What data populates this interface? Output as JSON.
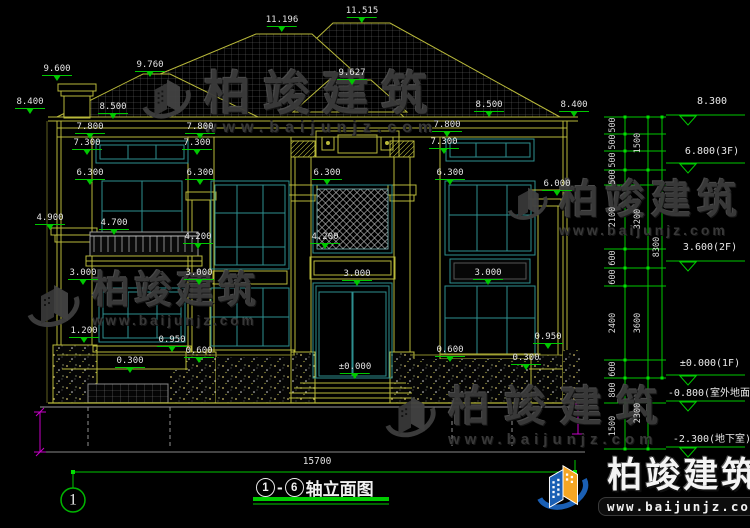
{
  "drawing": {
    "title_axis_start": "1",
    "title_axis_end": "6",
    "title_dash": "-",
    "title_suffix": "轴立面图",
    "overall_width_dim": "15700",
    "axis_bubble": "1"
  },
  "watermark": {
    "brand": "柏竣建筑",
    "url": "www.baijunjz.com"
  },
  "logo": {
    "brand": "柏竣建筑",
    "url": "www.baijunjz.com"
  },
  "dims": [
    {
      "text": "11.196",
      "x": 282,
      "y": 16
    },
    {
      "text": "11.515",
      "x": 362,
      "y": 7
    },
    {
      "text": "9.600",
      "x": 57,
      "y": 65
    },
    {
      "text": "9.760",
      "x": 150,
      "y": 61
    },
    {
      "text": "9.627",
      "x": 352,
      "y": 69
    },
    {
      "text": "8.400",
      "x": 30,
      "y": 98
    },
    {
      "text": "8.500",
      "x": 113,
      "y": 103
    },
    {
      "text": "8.500",
      "x": 489,
      "y": 101
    },
    {
      "text": "8.400",
      "x": 574,
      "y": 101
    },
    {
      "text": "7.800",
      "x": 90,
      "y": 123
    },
    {
      "text": "7.800",
      "x": 200,
      "y": 123
    },
    {
      "text": "7.800",
      "x": 447,
      "y": 121
    },
    {
      "text": "7.300",
      "x": 87,
      "y": 139
    },
    {
      "text": "7.300",
      "x": 197,
      "y": 139
    },
    {
      "text": "7.300",
      "x": 444,
      "y": 138
    },
    {
      "text": "6.300",
      "x": 90,
      "y": 169
    },
    {
      "text": "6.300",
      "x": 200,
      "y": 169
    },
    {
      "text": "6.300",
      "x": 327,
      "y": 169
    },
    {
      "text": "6.300",
      "x": 450,
      "y": 169
    },
    {
      "text": "6.000",
      "x": 557,
      "y": 180
    },
    {
      "text": "4.900",
      "x": 50,
      "y": 214
    },
    {
      "text": "4.700",
      "x": 114,
      "y": 219
    },
    {
      "text": "4.200",
      "x": 198,
      "y": 233
    },
    {
      "text": "4.200",
      "x": 325,
      "y": 233
    },
    {
      "text": "3.000",
      "x": 83,
      "y": 269
    },
    {
      "text": "3.000",
      "x": 199,
      "y": 269
    },
    {
      "text": "3.000",
      "x": 357,
      "y": 270
    },
    {
      "text": "3.000",
      "x": 488,
      "y": 269
    },
    {
      "text": "1.200",
      "x": 84,
      "y": 327
    },
    {
      "text": "0.950",
      "x": 172,
      "y": 336
    },
    {
      "text": "0.600",
      "x": 199,
      "y": 347
    },
    {
      "text": "0.300",
      "x": 130,
      "y": 357
    },
    {
      "text": "±0.000",
      "x": 355,
      "y": 363
    },
    {
      "text": "0.600",
      "x": 450,
      "y": 346
    },
    {
      "text": "0.950",
      "x": 548,
      "y": 333
    },
    {
      "text": "0.300",
      "x": 526,
      "y": 354
    }
  ],
  "elevations": [
    {
      "text": "8.300",
      "x": 712,
      "y": 96
    },
    {
      "text": "6.800(3F)",
      "x": 712,
      "y": 146
    },
    {
      "text": "3.600(2F)",
      "x": 710,
      "y": 242
    },
    {
      "text": "±0.000(1F)",
      "x": 710,
      "y": 358
    },
    {
      "text": "-0.800(室外地面)",
      "x": 712,
      "y": 384
    },
    {
      "text": "-2.300(地下室)",
      "x": 712,
      "y": 430
    }
  ],
  "chain_dims": [
    {
      "text": "500",
      "x": 613,
      "y": 125
    },
    {
      "text": "500",
      "x": 613,
      "y": 142
    },
    {
      "text": "500",
      "x": 613,
      "y": 160
    },
    {
      "text": "500",
      "x": 613,
      "y": 177
    },
    {
      "text": "2100",
      "x": 613,
      "y": 217
    },
    {
      "text": "600",
      "x": 613,
      "y": 258
    },
    {
      "text": "600",
      "x": 613,
      "y": 277
    },
    {
      "text": "2400",
      "x": 613,
      "y": 323
    },
    {
      "text": "600",
      "x": 613,
      "y": 369
    },
    {
      "text": "800",
      "x": 613,
      "y": 390
    },
    {
      "text": "1500",
      "x": 613,
      "y": 426
    },
    {
      "text": "1500",
      "x": 638,
      "y": 143
    },
    {
      "text": "3200",
      "x": 638,
      "y": 219
    },
    {
      "text": "3600",
      "x": 638,
      "y": 323
    },
    {
      "text": "2300",
      "x": 638,
      "y": 413
    },
    {
      "text": "8300",
      "x": 657,
      "y": 247
    }
  ],
  "colors": {
    "background": "#000000",
    "cad_yellow": "#b9b93a",
    "cad_teal": "#2e8f8f",
    "dim_green": "#00c800",
    "text_white": "#e4e4e4",
    "magenta": "#c800c8",
    "watermark_gray": "#3b3b3b",
    "logo_blue": "#1a5fb4",
    "logo_orange": "#f5a623",
    "title_underline": "#00cc00"
  }
}
